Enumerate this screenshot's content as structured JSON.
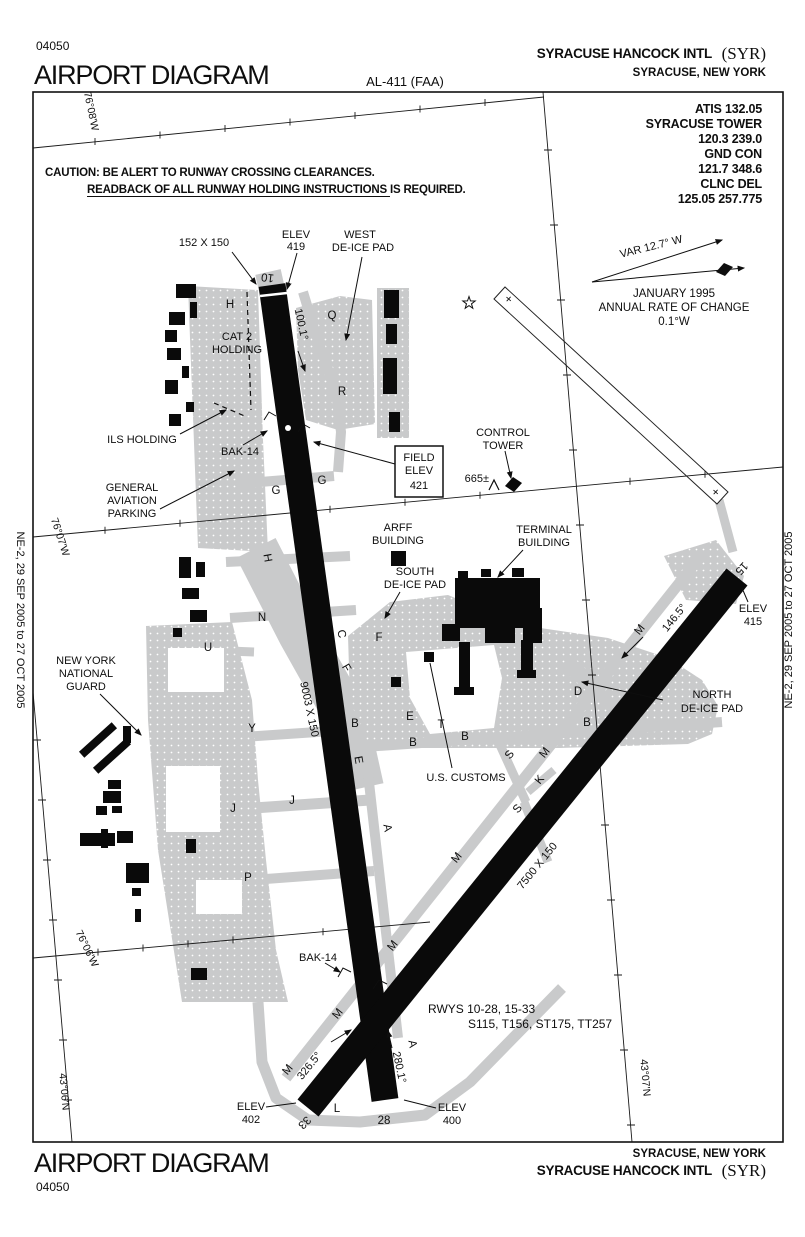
{
  "page": {
    "chart_number": "04050",
    "title": "AIRPORT DIAGRAM",
    "procedure_id": "AL-411 (FAA)",
    "airport_name": "SYRACUSE HANCOCK INTL",
    "airport_code": "(SYR)",
    "city_state": "SYRACUSE, NEW YORK"
  },
  "edition": {
    "left": "NE-2, 29 SEP 2005 to 27 OCT 2005",
    "right": "NE-2, 29 SEP 2005 to 27 OCT 2005"
  },
  "frequencies": {
    "lines": [
      "ATIS 132.05",
      "SYRACUSE TOWER",
      "120.3  239.0",
      "GND CON",
      "121.7  348.6",
      "CLNC DEL",
      "125.05  257.775"
    ]
  },
  "caution": {
    "line1": "CAUTION: BE ALERT TO RUNWAY CROSSING CLEARANCES.",
    "line2": "READBACK OF ALL RUNWAY HOLDING INSTRUCTIONS IS REQUIRED."
  },
  "variation": {
    "var": "VAR 12.7° W",
    "date": "JANUARY 1995",
    "rate1": "ANNUAL RATE OF CHANGE",
    "rate2": "0.1°W"
  },
  "graticule": {
    "lon_08": "76°08'W",
    "lon_07": "76°07'W",
    "lon_06": "76°06'W",
    "lat_07": "43°07'N",
    "lat_06": "43°06'N"
  },
  "runways": {
    "rw10": "10",
    "rw28": "28",
    "rw15": "15",
    "rw33": "33",
    "dim_10_28": "9003 X 150",
    "dim_15_33": "7500 X 150",
    "displaced_dim": "152 X 150",
    "hdg10": "100.1°",
    "hdg28": "280.1°",
    "hdg15": "146.5°",
    "hdg33": "326.5°",
    "note1": "RWYS 10-28, 15-33",
    "note2": "S115, T156, ST175, TT257",
    "plus": "+"
  },
  "elevations": {
    "elev_label": "ELEV",
    "e419": "419",
    "e415": "415",
    "e402": "402",
    "e400": "400",
    "field1": "FIELD",
    "field2": "ELEV",
    "field3": "421",
    "tower_elev": "665±"
  },
  "facilities": {
    "west": "WEST",
    "south": "SOUTH",
    "north": "NORTH",
    "deice_pad": "DE-ICE PAD",
    "cat2_1": "CAT 2",
    "cat2_2": "HOLDING",
    "ils": "ILS HOLDING",
    "bak14": "BAK-14",
    "ga1": "GENERAL",
    "ga2": "AVIATION",
    "ga3": "PARKING",
    "ct1": "CONTROL",
    "ct2": "TOWER",
    "arff": "ARFF",
    "building": "BUILDING",
    "terminal": "TERMINAL",
    "guard1": "NEW YORK",
    "guard2": "NATIONAL",
    "guard3": "GUARD",
    "customs": "U.S. CUSTOMS"
  },
  "twy": {
    "a": "A",
    "b": "B",
    "c": "C",
    "d": "D",
    "e": "E",
    "f": "F",
    "g": "G",
    "h": "H",
    "j": "J",
    "k": "K",
    "l": "L",
    "m": "M",
    "n": "N",
    "p": "P",
    "q": "Q",
    "r": "R",
    "s": "S",
    "t": "T",
    "u": "U",
    "y": "Y"
  }
}
